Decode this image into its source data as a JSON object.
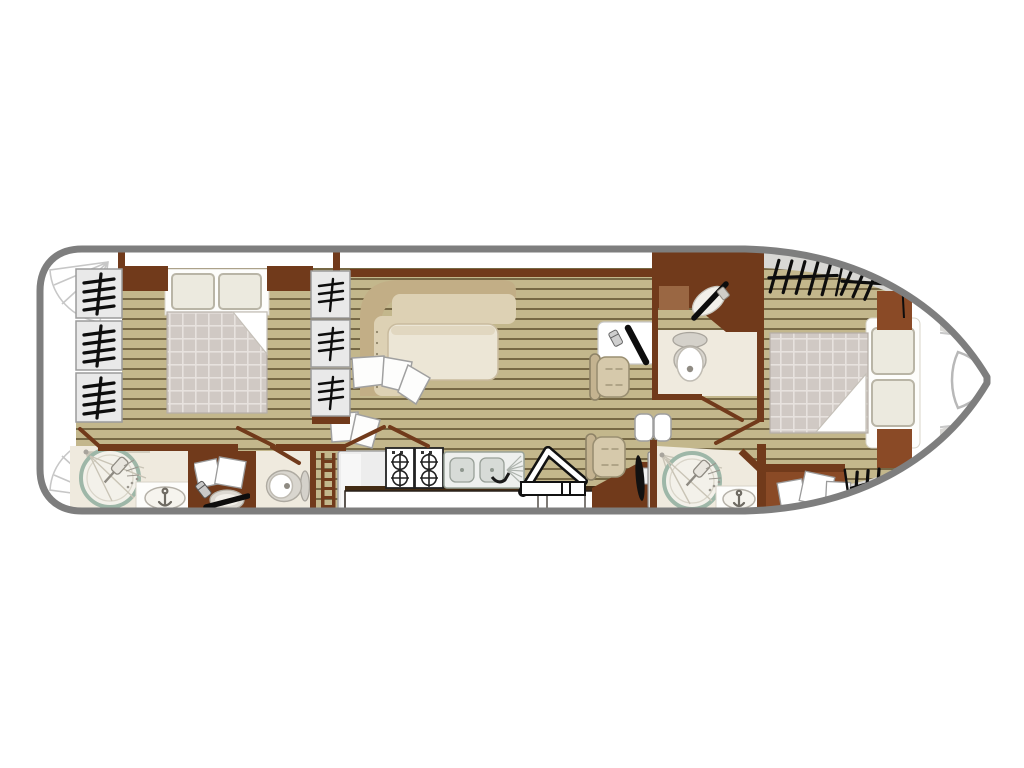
{
  "diagram": {
    "kind": "boat-floor-plan",
    "orientation": {
      "bow": "right",
      "stern": "left"
    },
    "rooms": [
      {
        "name": "aft-cabin",
        "furniture": [
          "double-bed",
          "wardrobe-port",
          "wardrobe-starboard"
        ],
        "windows": 6
      },
      {
        "name": "aft-bathroom",
        "furniture": [
          "shower",
          "washbasin",
          "vanity-desk",
          "toilet",
          "ladder"
        ]
      },
      {
        "name": "saloon",
        "furniture": [
          "l-shaped-sofa",
          "table",
          "companion-steps"
        ]
      },
      {
        "name": "galley",
        "furniture": [
          "fridge",
          "two-burner-hob",
          "two-burner-hob",
          "double-sink",
          "counter",
          "entry-ladder"
        ]
      },
      {
        "name": "helm-station",
        "furniture": [
          "chart-console",
          "steering-wheel",
          "throttle-panel",
          "helm-seat-front",
          "helm-seat-rear"
        ]
      },
      {
        "name": "fore-bathroom",
        "furniture": [
          "corner-washbasin",
          "toilet"
        ]
      },
      {
        "name": "fore-shower-room",
        "furniture": [
          "shower",
          "washbasin"
        ]
      },
      {
        "name": "fore-cabin",
        "furniture": [
          "double-bed",
          "corner-cupboard-top",
          "corner-cupboard-bottom",
          "storage-cabinet"
        ],
        "windows": 3
      }
    ],
    "deck_features": [
      "stern-step-fan-top",
      "stern-step-fan-bottom",
      "bow-seat",
      "bow-side-decks"
    ]
  },
  "colors": {
    "hull-stroke": "#7e7e7e",
    "deck-gray": "#d9d8d5",
    "wood": "#c3b78c",
    "plank-line": "#6d5f3d",
    "wall": "#713a1b",
    "cabinet": "#8a4a26",
    "cream": "#efeade",
    "teal": "#9eb7a8",
    "sofa-band": "#c2ae86",
    "cushion": "#ddd1b4",
    "table": "#ece6d6",
    "quilt": "#d0c9c4",
    "quilt-line": "#e7e2de",
    "pillow": "#eceadf",
    "ink": "#0d0d0d",
    "window-box": "#e9e9e9",
    "window-frame": "#9b9b9b"
  }
}
